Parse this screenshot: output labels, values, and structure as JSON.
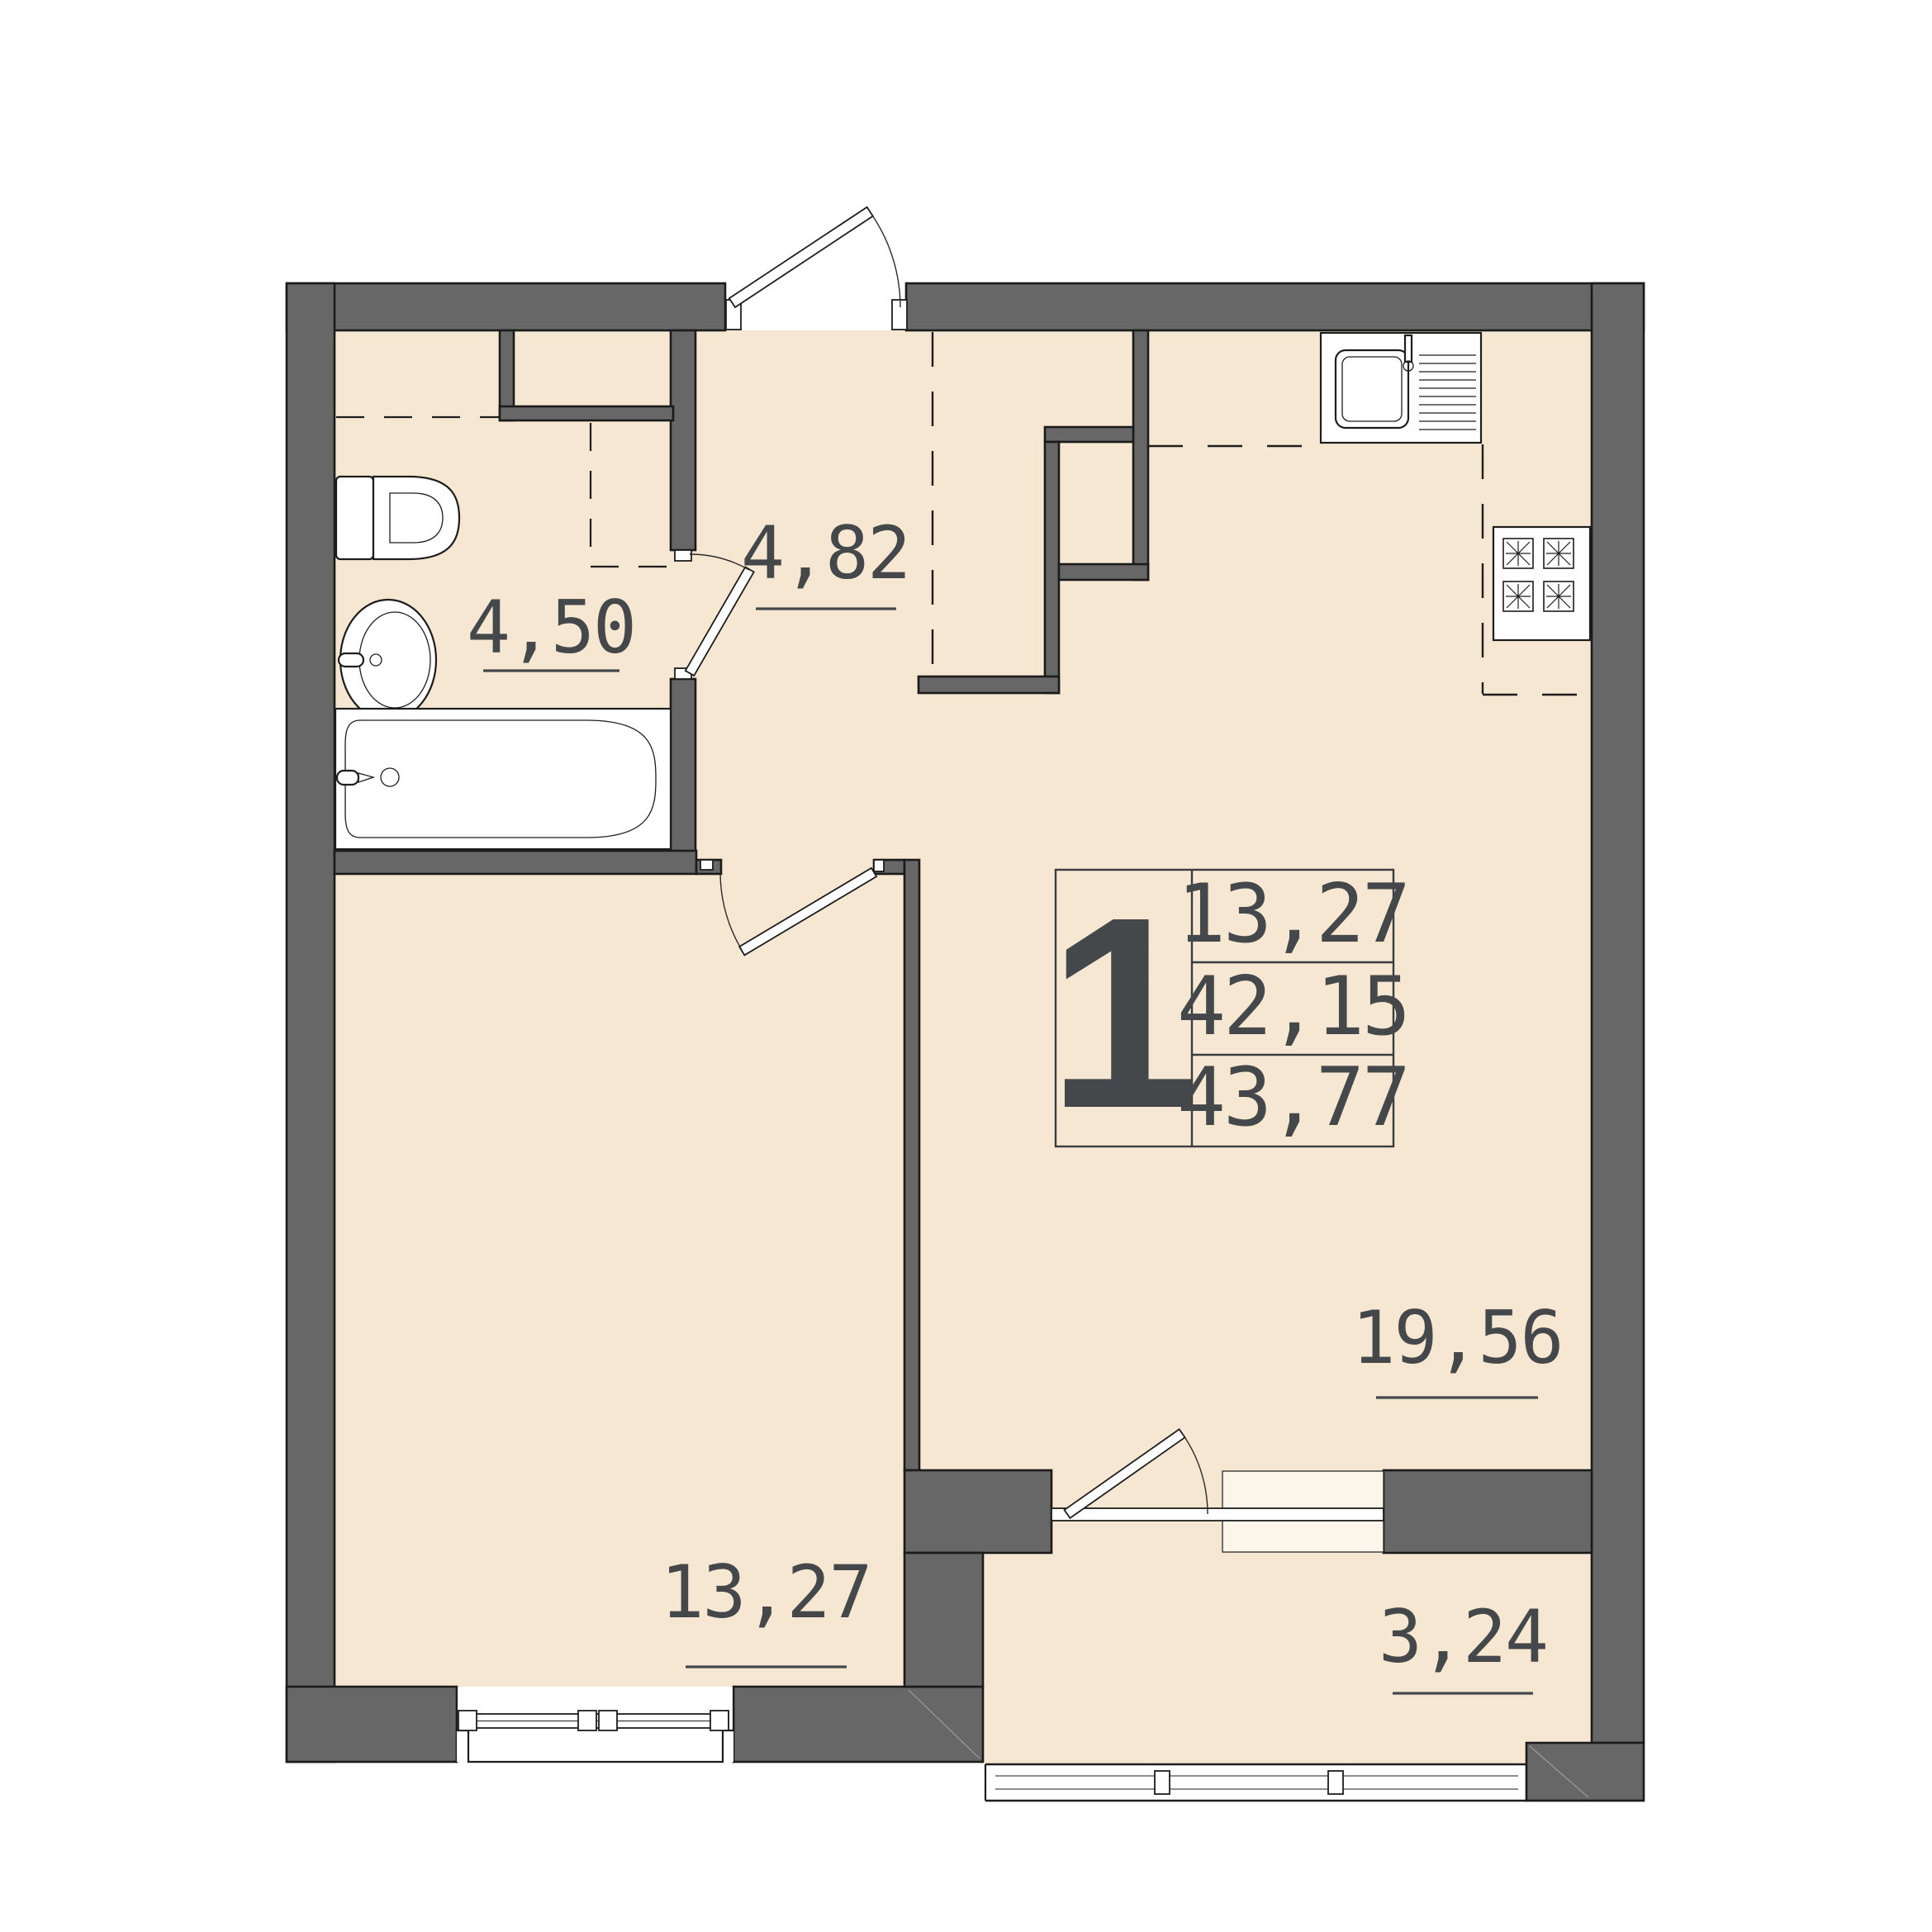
{
  "unit_info": {
    "rooms_count": "1",
    "living_area": "13,27",
    "apartment_area": "42,15",
    "total_area": "43,77"
  },
  "rooms": [
    {
      "id": "bathroom",
      "area": "4,50"
    },
    {
      "id": "hallway",
      "area": "4,82"
    },
    {
      "id": "bedroom",
      "area": "13,27"
    },
    {
      "id": "living-kitchen",
      "area": "19,56"
    },
    {
      "id": "balcony",
      "area": "3,24"
    }
  ],
  "fixtures": [
    "toilet",
    "washbasin",
    "bathtub",
    "ventilation-shaft",
    "kitchen-sink",
    "stove-4-burner",
    "entrance-door",
    "bathroom-door",
    "bedroom-door",
    "balcony-door",
    "bedroom-window",
    "balcony-window",
    "balcony-window-insert"
  ],
  "colors": {
    "floor": "#f5e7d2",
    "wall_fill": "#676767",
    "wall_outline": "#1b1b1b",
    "text": "#45484b",
    "window_insert": "#fbf5ea",
    "background": "#ffffff"
  }
}
